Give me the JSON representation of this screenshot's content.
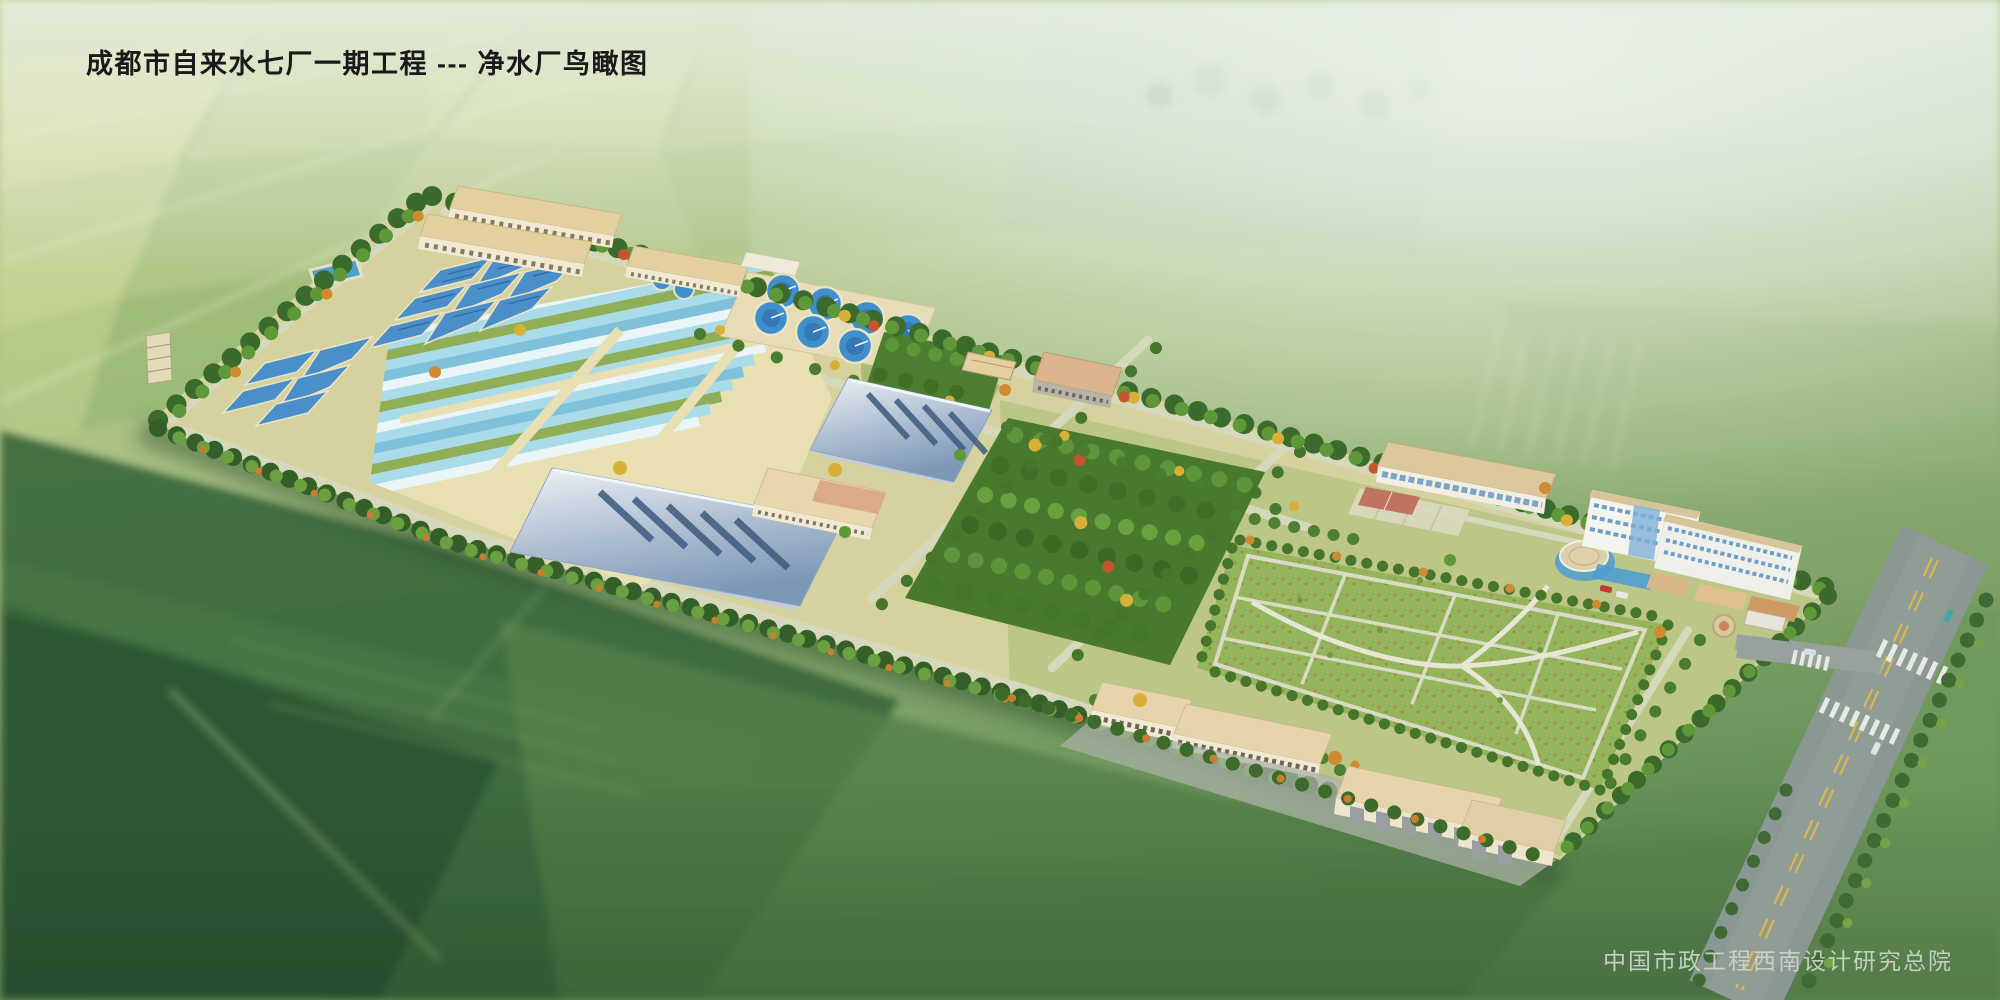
{
  "header": {
    "title": "成都市自来水七厂一期工程 --- 净水厂鸟瞰图"
  },
  "footer": {
    "credit": "中国市政工程西南设计研究总院"
  },
  "scene": {
    "subject": "water-treatment-plant-birdseye-rendering",
    "colors": {
      "title-text": "#1a1a1a",
      "credit-text": "#ccd6cc",
      "site-ground": "#d5d2a0",
      "water-strip": "#a9dbe9",
      "tank-blue": "#4a8fc9",
      "clarifier-water": "#3f8fca",
      "roof-tan": "#e3cf9f",
      "wall-cream": "#f2e9d2",
      "tree-dark": "#3a6a2c",
      "tree-mid": "#5f9838",
      "tree-light": "#7fb04a",
      "tree-yellow": "#d8b038",
      "tree-orange": "#d08a30",
      "tree-red": "#c4562e",
      "lawn-green": "#93b55c",
      "path-light": "#d6d8bc",
      "road-gray": "#8b9792",
      "road-yellow": "#d9b74d",
      "glass-blue": "#6f9cc8",
      "court-pink": "#c06a58",
      "field-dark": "#2d5634",
      "haze": "#e9f1e8",
      "car-red": "#c23b30"
    }
  }
}
